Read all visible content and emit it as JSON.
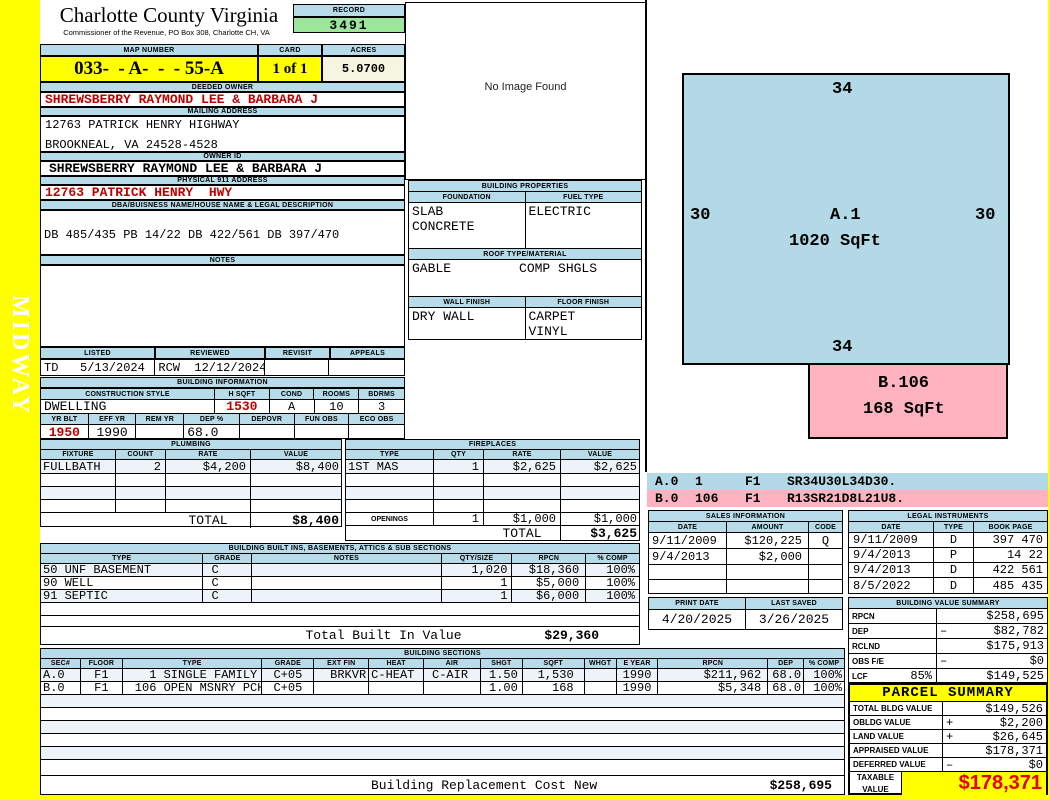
{
  "colors": {
    "accent_blue": "#b7dbe8",
    "highlight_yellow": "#ffff00",
    "record_green": "#9ce69c",
    "acres_cream": "#f5f5e0",
    "alert_red": "#c00000",
    "sketch_pink": "#ffb3c0",
    "sketch_blue": "#b3d9e6"
  },
  "watermark": "MIDWAY",
  "header": {
    "county": "Charlotte County Virginia",
    "commissioner": "Commissioner of the Revenue, PO Box 308, Charlotte CH, VA",
    "record_label": "RECORD",
    "record": "3491",
    "map_number_label": "MAP NUMBER",
    "map_number": "033-  - A-  -  - 55-A",
    "card_label": "CARD",
    "card": "1 of 1",
    "acres_label": "ACRES",
    "acres": "5.0700"
  },
  "owner": {
    "deeded_owner_label": "DEEDED OWNER",
    "deeded_owner": "SHREWSBERRY RAYMOND LEE & BARBARA J",
    "mailing_address_label": "MAILING ADDRESS",
    "mailing_line1": "12763 PATRICK HENRY HIGHWAY",
    "mailing_line2": "BROOKNEAL, VA 24528-4528",
    "owner_id_label": "OWNER ID",
    "owner_id": "SHREWSBERRY RAYMOND LEE & BARBARA J",
    "physical_label": "PHYSICAL 911 ADDRESS",
    "physical": "12763 PATRICK HENRY  HWY",
    "legal_label": "DBA/BUISNESS NAME/HOUSE NAME & LEGAL DESCRIPTION",
    "legal_description": "DB 485/435 PB 14/22 DB 422/561 DB 397/470",
    "notes_label": "NOTES",
    "notes": ""
  },
  "review": {
    "listed_label": "LISTED",
    "listed": "TD   5/13/2024",
    "reviewed_label": "REVIEWED",
    "reviewed": "RCW  12/12/2024",
    "revisit_label": "REVISIT",
    "revisit": "",
    "appeals_label": "APPEALS",
    "appeals": ""
  },
  "building_info": {
    "title": "BUILDING INFORMATION",
    "style_label": "CONSTRUCTION STYLE",
    "style": "DWELLING",
    "hsqft_label": "H SQFT",
    "hsqft": "1530",
    "cond_label": "COND",
    "cond": "A",
    "rooms_label": "ROOMS",
    "rooms": "10",
    "bdrms_label": "BDRMS",
    "bdrms": "3",
    "yr_blt_label": "YR BLT",
    "yr_blt": "1950",
    "eff_yr_label": "EFF YR",
    "eff_yr": "1990",
    "rem_yr_label": "REM YR",
    "rem_yr": "",
    "dep_label": "DEP %",
    "dep": "68.0",
    "depovr_label": "DEPOVR",
    "depovr": "",
    "fun_obs_label": "FUN OBS",
    "fun_obs": "",
    "eco_obs_label": "ECO OBS",
    "eco_obs": ""
  },
  "image_box": {
    "no_image": "No Image Found"
  },
  "building_properties": {
    "title": "BUILDING PROPERTIES",
    "foundation_label": "FOUNDATION",
    "foundation_line1": "SLAB",
    "foundation_line2": "CONCRETE",
    "fuel_label": "FUEL TYPE",
    "fuel": "ELECTRIC",
    "roof_label": "ROOF TYPE/MATERIAL",
    "roof_type": "GABLE",
    "roof_material": "COMP SHGLS",
    "wall_label": "WALL FINISH",
    "wall": "DRY WALL",
    "floor_label": "FLOOR FINISH",
    "floor_line1": "CARPET",
    "floor_line2": "VINYL"
  },
  "plumbing": {
    "title": "PLUMBING",
    "headers": [
      "FIXTURE",
      "COUNT",
      "RATE",
      "VALUE"
    ],
    "rows": [
      {
        "fixture": "FULLBATH",
        "count": "2",
        "rate": "$4,200",
        "value": "$8,400"
      }
    ],
    "total_label": "TOTAL",
    "total": "$8,400"
  },
  "fireplaces": {
    "title": "FIREPLACES",
    "headers": [
      "TYPE",
      "QTY",
      "RATE",
      "VALUE"
    ],
    "rows": [
      {
        "type": "1ST MAS",
        "qty": "1",
        "rate": "$2,625",
        "value": "$2,625"
      }
    ],
    "openings_label": "OPENINGS",
    "openings_qty": "1",
    "openings_rate": "$1,000",
    "openings_value": "$1,000",
    "total_label": "TOTAL",
    "total": "$3,625"
  },
  "built_ins": {
    "title": "BUILDING BUILT INS, BASEMENTS, ATTICS & SUB SECTIONS",
    "headers": [
      "TYPE",
      "GRADE",
      "NOTES",
      "QTY/SIZE",
      "RPCN",
      "% COMP"
    ],
    "rows": [
      {
        "type": "50 UNF BASEMENT",
        "grade": "C",
        "notes": "",
        "qty": "1,020",
        "rpcn": "$18,360",
        "comp": "100%"
      },
      {
        "type": "90 WELL",
        "grade": "C",
        "notes": "",
        "qty": "1",
        "rpcn": "$5,000",
        "comp": "100%"
      },
      {
        "type": "91 SEPTIC",
        "grade": "C",
        "notes": "",
        "qty": "1",
        "rpcn": "$6,000",
        "comp": "100%"
      }
    ],
    "total_label": "Total Built In Value",
    "total": "$29,360"
  },
  "building_sections": {
    "title": "BUILDING SECTIONS",
    "headers": [
      "SEC#",
      "FLOOR",
      "TYPE",
      "GRADE",
      "EXT FIN",
      "HEAT",
      "AIR",
      "SHGT",
      "SQFT",
      "WHGT",
      "E YEAR",
      "RPCN",
      "DEP",
      "% COMP"
    ],
    "rows": [
      {
        "sec": "A.0",
        "floor": "F1",
        "type": "  1 SINGLE FAMILY",
        "grade": "C+05",
        "ext": "BRKVR",
        "heat": "C-HEAT",
        "air": "C-AIR",
        "shgt": "1.50",
        "sqft": "1,530",
        "whgt": "",
        "eyear": "1990",
        "rpcn": "$211,962",
        "dep": "68.0",
        "comp": "100%"
      },
      {
        "sec": "B.0",
        "floor": "F1",
        "type": "106 OPEN MSNRY PCH",
        "grade": "C+05",
        "ext": "",
        "heat": "",
        "air": "",
        "shgt": "1.00",
        "sqft": "168",
        "whgt": "",
        "eyear": "1990",
        "rpcn": "$5,348",
        "dep": "68.0",
        "comp": "100%"
      }
    ],
    "footer_label": "Building Replacement Cost New",
    "footer_value": "$258,695"
  },
  "sketch": {
    "a_label": "A.1",
    "a_sqft": "1020 SqFt",
    "a_top": "34",
    "a_left": "30",
    "a_right": "30",
    "a_bottom": "34",
    "b_label": "B.106",
    "b_sqft": "168 SqFt",
    "legend": [
      {
        "sec": "A.0",
        "code": "1",
        "floor": "F1",
        "trace": "SR34U30L34D30."
      },
      {
        "sec": "B.0",
        "code": "106",
        "floor": "F1",
        "trace": "R13SR21D8L21U8."
      }
    ]
  },
  "sales": {
    "title": "SALES INFORMATION",
    "headers": [
      "DATE",
      "AMOUNT",
      "CODE"
    ],
    "rows": [
      {
        "date": "9/11/2009",
        "amount": "$120,225",
        "code": "Q"
      },
      {
        "date": "9/4/2013",
        "amount": "$2,000",
        "code": ""
      }
    ]
  },
  "legal_instruments": {
    "title": "LEGAL INSTRUMENTS",
    "headers": [
      "DATE",
      "TYPE",
      "BOOK PAGE"
    ],
    "rows": [
      {
        "date": "9/11/2009",
        "type": "D",
        "book_page": "397 470"
      },
      {
        "date": "9/4/2013",
        "type": "P",
        "book_page": "14 22"
      },
      {
        "date": "9/4/2013",
        "type": "D",
        "book_page": "422 561"
      },
      {
        "date": "8/5/2022",
        "type": "D",
        "book_page": "485 435"
      }
    ]
  },
  "print_info": {
    "print_date_label": "PRINT DATE",
    "print_date": "4/20/2025",
    "last_saved_label": "LAST SAVED",
    "last_saved": "3/26/2025"
  },
  "value_summary": {
    "title": "BUILDING VALUE SUMMARY",
    "rows": [
      {
        "label": "RPCN",
        "extra": "",
        "sign": "",
        "value": "$258,695"
      },
      {
        "label": "DEP",
        "extra": "",
        "sign": "–",
        "value": "$82,782"
      },
      {
        "label": "RCLND",
        "extra": "",
        "sign": "",
        "value": "$175,913"
      },
      {
        "label": "OBS F/E",
        "extra": "",
        "sign": "–",
        "value": "$0"
      },
      {
        "label": "LCF",
        "extra": "85%",
        "sign": "",
        "value": "$149,525"
      }
    ]
  },
  "parcel_summary": {
    "title": "PARCEL SUMMARY",
    "rows": [
      {
        "label": "TOTAL BLDG VALUE",
        "sign": "",
        "value": "$149,526"
      },
      {
        "label": "OBLDG VALUE",
        "sign": "+",
        "value": "$2,200"
      },
      {
        "label": "LAND VALUE",
        "sign": "+",
        "value": "$26,645"
      },
      {
        "label": "APPRAISED VALUE",
        "sign": "",
        "value": "$178,371"
      },
      {
        "label": "DEFERRED VALUE",
        "sign": "–",
        "value": "$0"
      }
    ],
    "taxable_label": "TAXABLE VALUE",
    "taxable": "$178,371"
  }
}
